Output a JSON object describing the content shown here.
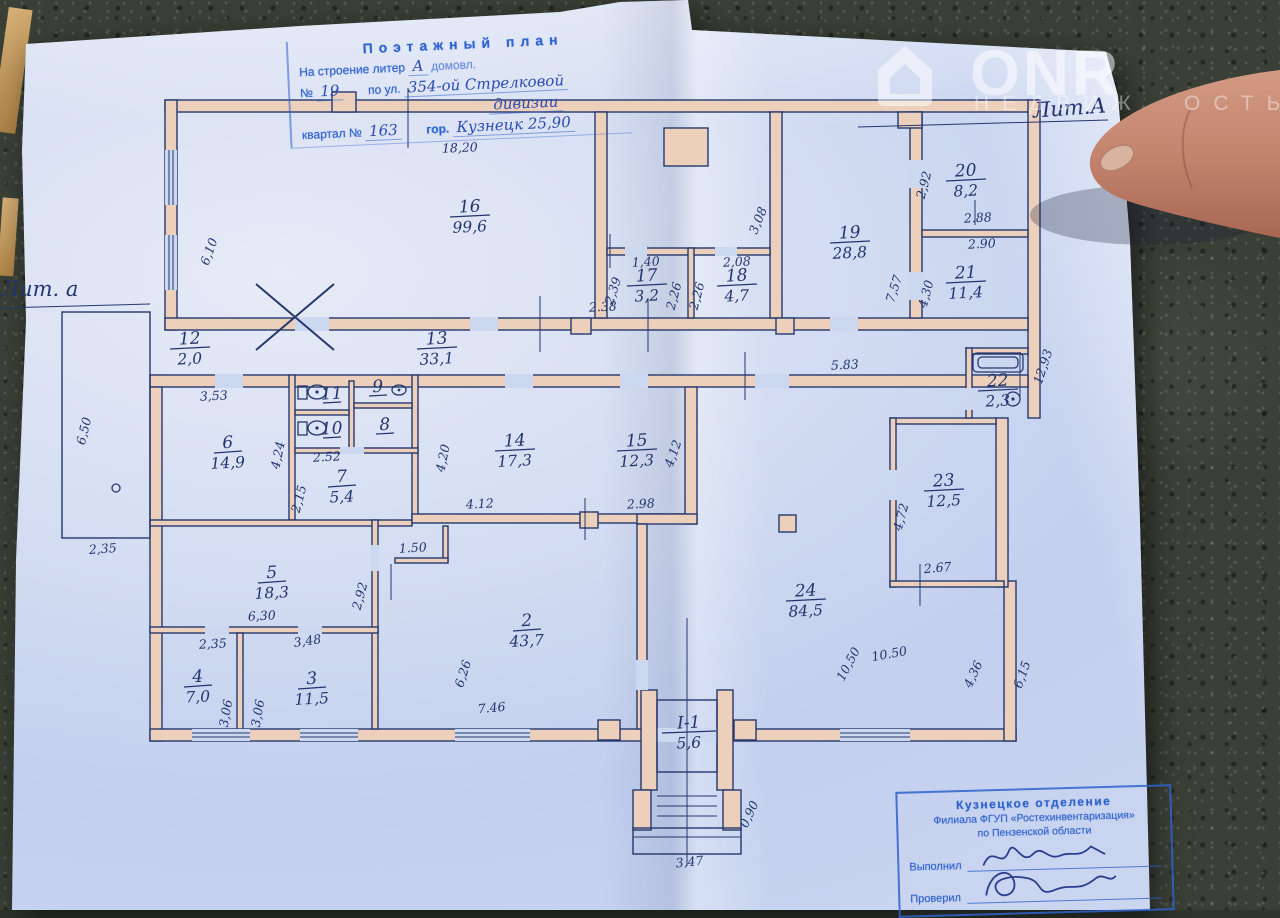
{
  "header_stamp": {
    "title": "Поэтажный план",
    "building_label": "На строение литер",
    "building_hand": "А",
    "building_tail": "домовл.",
    "number_label": "№",
    "number_hand": "19",
    "street_label": "по ул.",
    "street_hand": "354-ой Стрелковой",
    "street_hand2": "дивизии",
    "block_label": "квартал №",
    "block_hand": "163",
    "city_label": "гор.",
    "city_hand": "Кузнецк 25,90"
  },
  "annotations": {
    "liter_right": "Лит.А",
    "liter_left": "Лит. а"
  },
  "watermark": {
    "brand": "ONR",
    "letters1": "НЕДВИЖ",
    "letters2": "ОСТЬ"
  },
  "footer_stamp": {
    "line1": "Кузнецкое отделение",
    "line2": "Филиала ФГУП «Ростехинвентаризация»",
    "line3": "по Пензенской области",
    "executed_label": "Выполнил",
    "checked_label": "Проверил"
  },
  "plan": {
    "rooms": [
      {
        "num": "16",
        "area": "99,6",
        "x": 470,
        "y": 212
      },
      {
        "num": "17",
        "area": "3,2",
        "x": 647,
        "y": 281
      },
      {
        "num": "18",
        "area": "4,7",
        "x": 737,
        "y": 281
      },
      {
        "num": "19",
        "area": "28,8",
        "x": 850,
        "y": 238
      },
      {
        "num": "20",
        "area": "8,2",
        "x": 966,
        "y": 176
      },
      {
        "num": "21",
        "area": "11,4",
        "x": 966,
        "y": 278
      },
      {
        "num": "12",
        "area": "2,0",
        "x": 190,
        "y": 344
      },
      {
        "num": "13",
        "area": "33,1",
        "x": 437,
        "y": 344
      },
      {
        "num": "6",
        "area": "14,9",
        "x": 228,
        "y": 448
      },
      {
        "num": "11",
        "area": "",
        "x": 332,
        "y": 399
      },
      {
        "num": "9",
        "area": "",
        "x": 378,
        "y": 392
      },
      {
        "num": "10",
        "area": "",
        "x": 332,
        "y": 434
      },
      {
        "num": "8",
        "area": "",
        "x": 385,
        "y": 430
      },
      {
        "num": "7",
        "area": "5,4",
        "x": 342,
        "y": 482
      },
      {
        "num": "14",
        "area": "17,3",
        "x": 515,
        "y": 446
      },
      {
        "num": "15",
        "area": "12,3",
        "x": 637,
        "y": 446
      },
      {
        "num": "5",
        "area": "18,3",
        "x": 272,
        "y": 578
      },
      {
        "num": "4",
        "area": "7,0",
        "x": 198,
        "y": 682
      },
      {
        "num": "3",
        "area": "11,5",
        "x": 312,
        "y": 684
      },
      {
        "num": "2",
        "area": "43,7",
        "x": 527,
        "y": 626
      },
      {
        "num": "24",
        "area": "84,5",
        "x": 806,
        "y": 596
      },
      {
        "num": "23",
        "area": "12,5",
        "x": 944,
        "y": 486
      },
      {
        "num": "22",
        "area": "2,3",
        "x": 998,
        "y": 386
      },
      {
        "num": "I-1",
        "area": "5,6",
        "x": 689,
        "y": 728
      }
    ],
    "dims": [
      {
        "v": "18,20",
        "x": 460,
        "y": 152,
        "rot": -2
      },
      {
        "v": "6,10",
        "x": 213,
        "y": 253,
        "rot": -70
      },
      {
        "v": "2,35",
        "x": 103,
        "y": 553,
        "rot": -4
      },
      {
        "v": "6,50",
        "x": 88,
        "y": 432,
        "rot": -76
      },
      {
        "v": "2.38",
        "x": 603,
        "y": 311,
        "rot": -3
      },
      {
        "v": "3,53",
        "x": 214,
        "y": 400,
        "rot": -3
      },
      {
        "v": "1,40",
        "x": 646,
        "y": 266,
        "rot": -3
      },
      {
        "v": "2,08",
        "x": 737,
        "y": 266,
        "rot": -3
      },
      {
        "v": "2,39",
        "x": 617,
        "y": 292,
        "rot": -72
      },
      {
        "v": "2,26",
        "x": 678,
        "y": 297,
        "rot": -75
      },
      {
        "v": "2,26",
        "x": 701,
        "y": 297,
        "rot": -75
      },
      {
        "v": "3,08",
        "x": 762,
        "y": 222,
        "rot": -68
      },
      {
        "v": "7,57",
        "x": 898,
        "y": 290,
        "rot": -72
      },
      {
        "v": "2,92",
        "x": 928,
        "y": 186,
        "rot": -75
      },
      {
        "v": "2.88",
        "x": 978,
        "y": 222,
        "rot": -3
      },
      {
        "v": "2.90",
        "x": 982,
        "y": 248,
        "rot": -3
      },
      {
        "v": "4,30",
        "x": 930,
        "y": 295,
        "rot": -75
      },
      {
        "v": "12,93",
        "x": 1047,
        "y": 368,
        "rot": -72
      },
      {
        "v": "5.83",
        "x": 845,
        "y": 369,
        "rot": -3
      },
      {
        "v": "4,24",
        "x": 282,
        "y": 456,
        "rot": -78
      },
      {
        "v": "2.52",
        "x": 327,
        "y": 461,
        "rot": -3
      },
      {
        "v": "2,15",
        "x": 303,
        "y": 500,
        "rot": -75
      },
      {
        "v": "4,20",
        "x": 447,
        "y": 459,
        "rot": -78
      },
      {
        "v": "4.12",
        "x": 480,
        "y": 508,
        "rot": -3
      },
      {
        "v": "2.98",
        "x": 641,
        "y": 508,
        "rot": -3
      },
      {
        "v": "4,12",
        "x": 677,
        "y": 455,
        "rot": -70
      },
      {
        "v": "2,35",
        "x": 213,
        "y": 648,
        "rot": -3
      },
      {
        "v": "3,48",
        "x": 308,
        "y": 645,
        "rot": -8
      },
      {
        "v": "6,30",
        "x": 262,
        "y": 620,
        "rot": -3
      },
      {
        "v": "2,92",
        "x": 364,
        "y": 597,
        "rot": -75
      },
      {
        "v": "3,06",
        "x": 230,
        "y": 714,
        "rot": -80
      },
      {
        "v": "3,06",
        "x": 262,
        "y": 714,
        "rot": -80
      },
      {
        "v": "1.50",
        "x": 413,
        "y": 552,
        "rot": -3
      },
      {
        "v": "6,26",
        "x": 467,
        "y": 675,
        "rot": -72
      },
      {
        "v": "7.46",
        "x": 492,
        "y": 712,
        "rot": -5
      },
      {
        "v": "10,50",
        "x": 852,
        "y": 666,
        "rot": -62
      },
      {
        "v": "10.50",
        "x": 890,
        "y": 658,
        "rot": -10
      },
      {
        "v": "4,36",
        "x": 977,
        "y": 676,
        "rot": -65
      },
      {
        "v": "6,15",
        "x": 1026,
        "y": 676,
        "rot": -70
      },
      {
        "v": "2.67",
        "x": 938,
        "y": 572,
        "rot": -5
      },
      {
        "v": "4,72",
        "x": 905,
        "y": 518,
        "rot": -75
      },
      {
        "v": "3,47",
        "x": 690,
        "y": 866,
        "rot": -6
      },
      {
        "v": "0,90",
        "x": 753,
        "y": 816,
        "rot": -65
      }
    ]
  }
}
